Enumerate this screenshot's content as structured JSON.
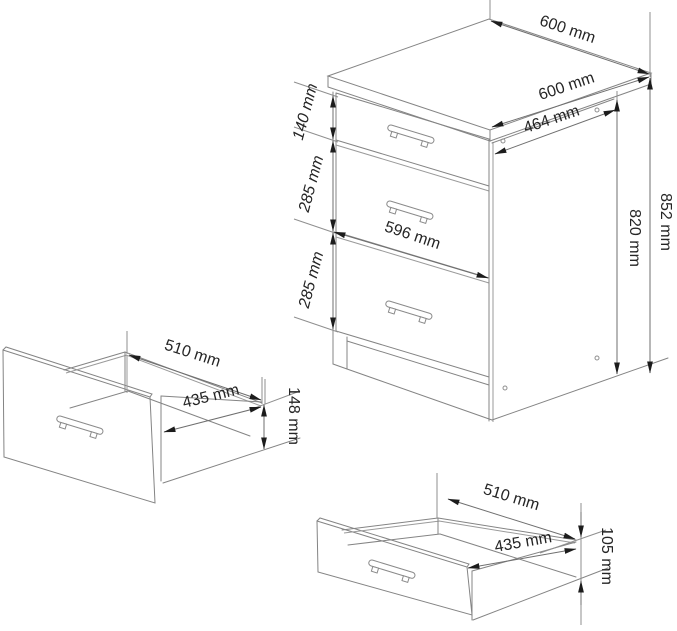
{
  "diagram": {
    "title": "kitchen-cabinet-dimension-drawing",
    "unit": "mm",
    "cabinet": {
      "top_width": "600 mm",
      "top_depth": "600 mm",
      "side_depth": "464 mm",
      "drawer_front_width": "596 mm",
      "top_drawer_front_height": "140 mm",
      "middle_drawer_front_height": "285 mm",
      "bottom_drawer_front_height": "285 mm",
      "height_without_top": "820 mm",
      "total_height": "852 mm"
    },
    "large_drawer": {
      "depth": "510 mm",
      "inner_width": "435 mm",
      "box_height": "148 mm"
    },
    "small_drawer": {
      "depth": "510 mm",
      "inner_width": "435 mm",
      "box_height": "105 mm"
    },
    "colors": {
      "background": "#ffffff",
      "line": "#848484",
      "dimension_line": "#6f6f6f",
      "arrow": "#1c1c1c",
      "text": "#252525"
    }
  }
}
